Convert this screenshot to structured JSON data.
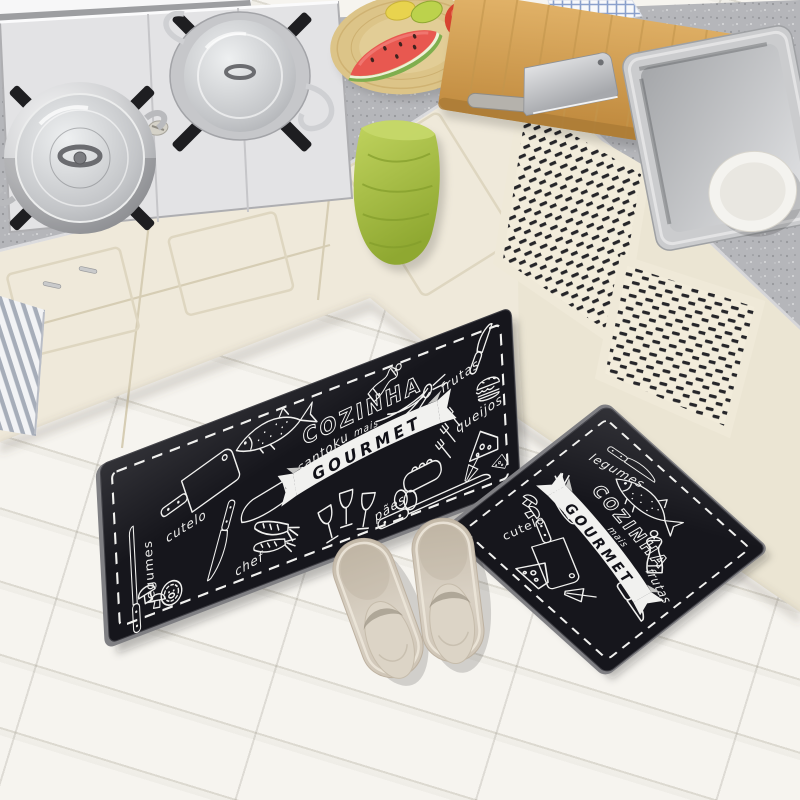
{
  "image": {
    "domain": "photograph",
    "scene_objects": [
      "gas stove",
      "stock pot with glass lid",
      "saucepan with wire handles",
      "stove knobs",
      "gray speckled countertop",
      "cream cabinet doors",
      "lattice vent cabinet panels",
      "wooden fruit plate",
      "watermelon slice",
      "tomato",
      "green fruit",
      "checkered cloth",
      "wooden cutting board",
      "steel cleaver",
      "stainless kitchen sink",
      "white ceramic bowl",
      "green hand towel",
      "gray striped cloth",
      "white wood plank floor",
      "black kitchen mat runner",
      "black kitchen door mat",
      "pair of beige slippers"
    ]
  },
  "colors": {
    "mat_black": "#16161c",
    "mat_print": "#f1f1ef",
    "countertop_gray": "#b5b6ba",
    "cabinet_cream": "#efe9da",
    "towel_green": "#a9bf44",
    "floor_white": "#f1efe9",
    "cutting_board_wood": "#d3a057",
    "slipper_beige": "#cfc5b6",
    "watermelon_red": "#e85850",
    "tomato_red": "#d84430"
  },
  "long_mat": {
    "title": {
      "top": "COZINHA",
      "middle": "mais",
      "banner": "GOURMET"
    },
    "labels": {
      "legumes": "legumes",
      "cutelo": "cutelo",
      "santoku": "santoku",
      "chef": "chef",
      "frutas": "frutas",
      "queijos": "queijos",
      "paes": "pães"
    }
  },
  "small_mat": {
    "title": {
      "top": "COZINHA",
      "middle": "mais",
      "banner": "GOURMET"
    },
    "labels": {
      "legumes": "legumes",
      "cutelo": "cutelo",
      "frutas": "frutas"
    }
  }
}
